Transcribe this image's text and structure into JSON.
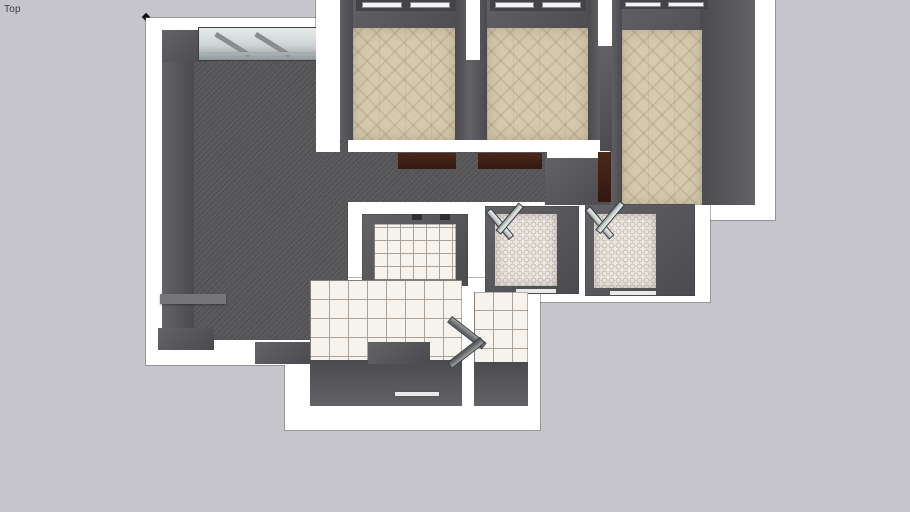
{
  "app": {
    "view_label": "Top"
  },
  "viewport": {
    "type": "3d-model-top-view",
    "description": "Top-down perspective view of an apartment floor-plan model on a plain canvas"
  },
  "colors": {
    "background": "#c5c5cb",
    "wall_top": "#ffffff",
    "wall_face": "#636367",
    "wall_face_dark": "#4b4b4f",
    "carpet": "#57575a",
    "wood_floor": "#d6c9ad",
    "tile": "#f6f3ed",
    "grout": "#aaa298",
    "hex_base": "#eae6e0",
    "hex_dot": "#c0b7ac",
    "door_wood": "#33190f",
    "glass": "#cdd3d4",
    "label_color": "#3c3c3c"
  },
  "scene": {
    "rooms": [
      {
        "id": "living-room",
        "floor": "dark-carpet"
      },
      {
        "id": "hallway",
        "floor": "dark-carpet"
      },
      {
        "id": "bedroom-left",
        "floor": "herringbone-wood"
      },
      {
        "id": "bedroom-middle",
        "floor": "herringbone-wood"
      },
      {
        "id": "bedroom-right",
        "floor": "herringbone-wood"
      },
      {
        "id": "storage-room",
        "floor": "white-square-tile"
      },
      {
        "id": "bathroom-left",
        "floor": "hex-mosaic-tile"
      },
      {
        "id": "bathroom-right",
        "floor": "hex-mosaic-tile"
      },
      {
        "id": "kitchen",
        "floor": "white-square-tile"
      },
      {
        "id": "utility-room",
        "floor": "white-square-tile"
      }
    ],
    "fixtures": [
      "living-room-window-unit",
      "bedroom-left-window",
      "bedroom-middle-window",
      "bedroom-right-window",
      "bathroom-left-shower-screen",
      "bathroom-right-shower-screen",
      "hallway-open-doors",
      "kitchen-open-door",
      "axis-origin-dot"
    ]
  }
}
